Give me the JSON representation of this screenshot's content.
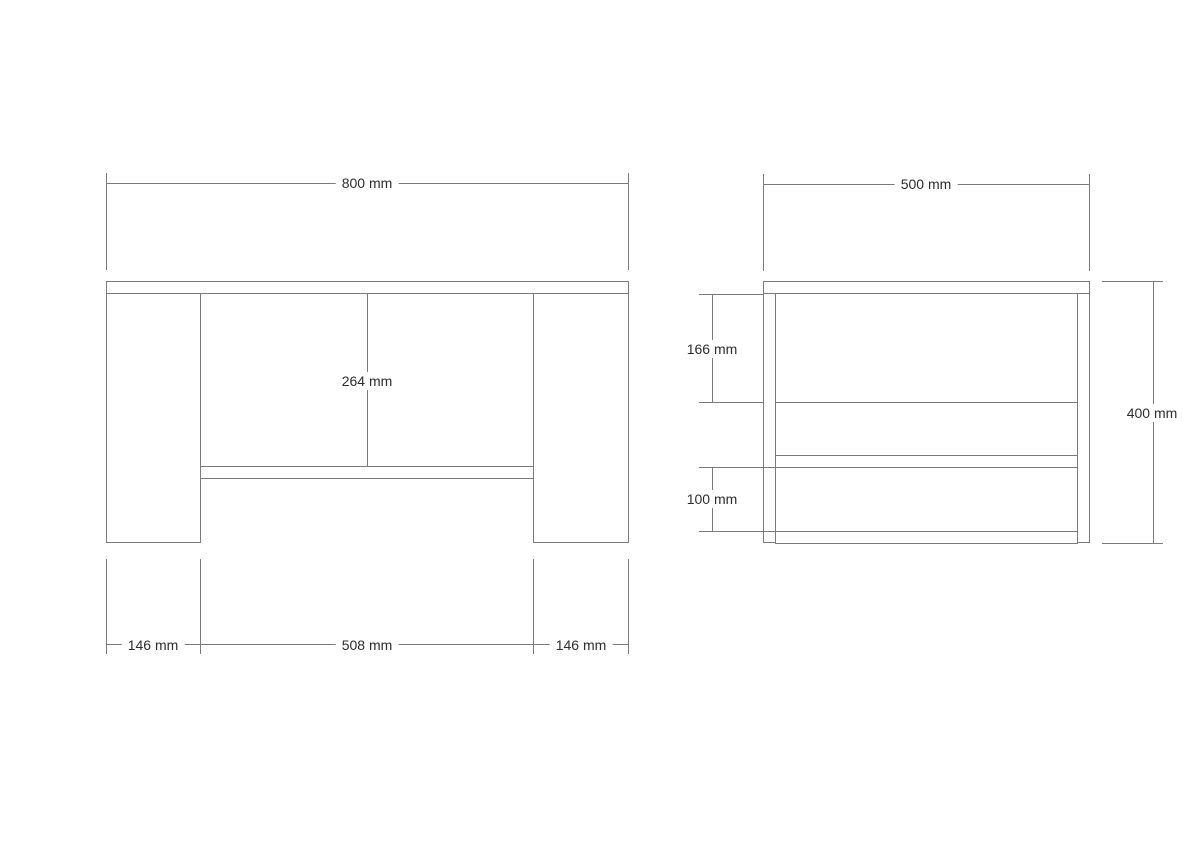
{
  "page": {
    "background": "#ffffff"
  },
  "drawing": {
    "type": "furniture orthographic technical drawing (front and side views of a table/bench)",
    "views": {
      "front": {
        "overall_width": "800 mm",
        "opening_height": "264 mm",
        "left_leg_width": "146 mm",
        "opening_width": "508 mm",
        "right_leg_width": "146 mm"
      },
      "side": {
        "depth": "500 mm",
        "upper_opening_height": "166 mm",
        "lower_opening_height": "100 mm",
        "overall_height": "400 mm"
      }
    },
    "colors": {
      "line": "#7b7b7b",
      "text": "#2d2d2d"
    }
  }
}
